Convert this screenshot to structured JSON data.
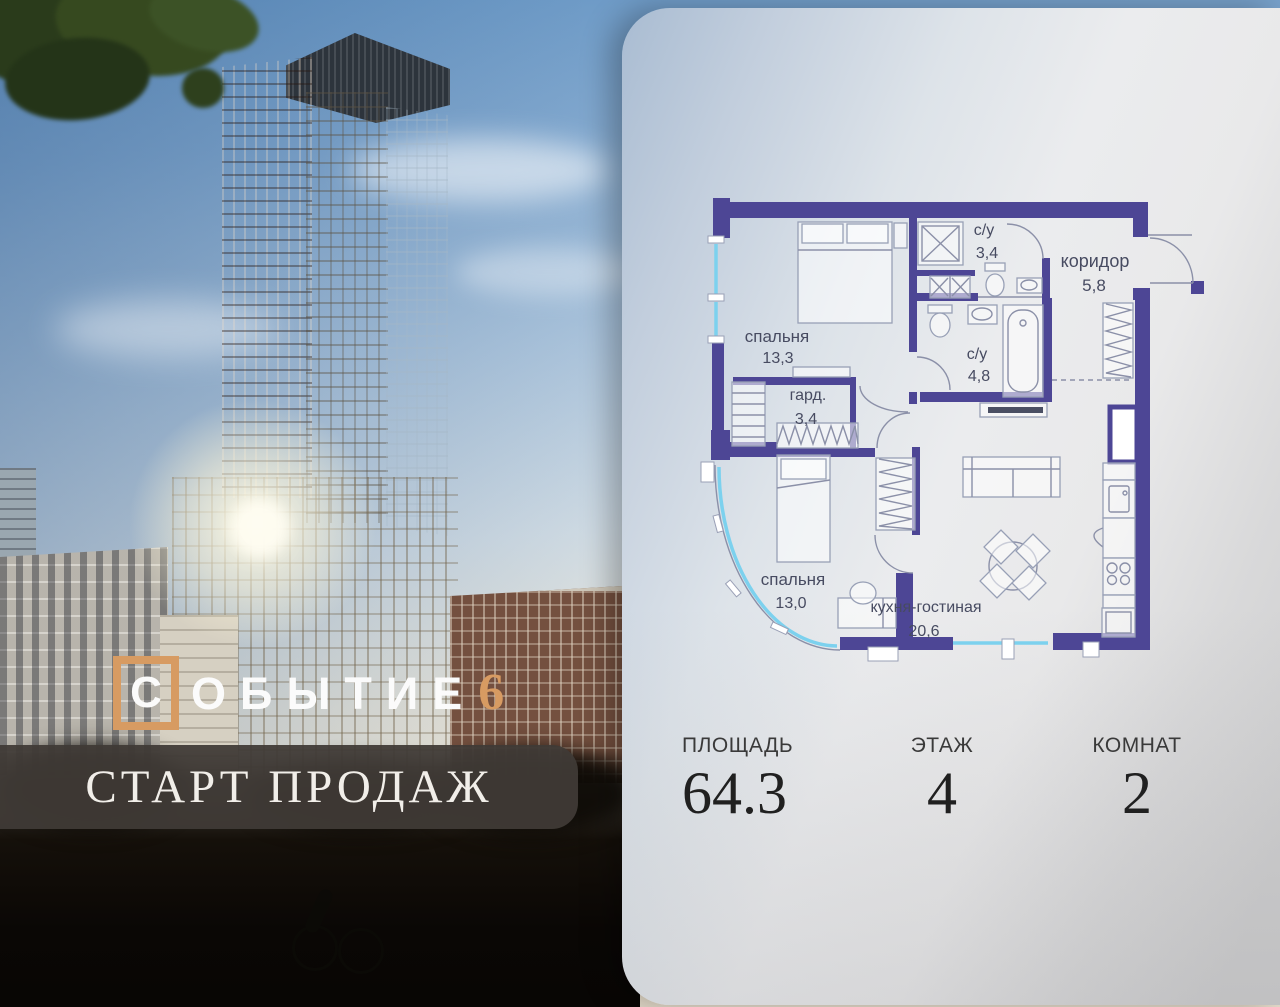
{
  "logo": {
    "boxed_letter": "С",
    "rest": "ОБЫТИЕ",
    "number": "6"
  },
  "banner": {
    "text": "СТАРТ ПРОДАЖ"
  },
  "floorplan": {
    "rooms": [
      {
        "name": "спальня",
        "area": "13,3"
      },
      {
        "name": "с/у",
        "area": "3,4"
      },
      {
        "name": "коридор",
        "area": "5,8"
      },
      {
        "name": "с/у",
        "area": "4,8"
      },
      {
        "name": "гард.",
        "area": "3,4"
      },
      {
        "name": "спальня",
        "area": "13,0"
      },
      {
        "name": "кухня-гостиная",
        "area": "20,6"
      }
    ],
    "colors": {
      "wall": "#4d4695",
      "window": "#7cd1ee",
      "furniture": "#98a0b6",
      "label": "#474b61"
    }
  },
  "stats": {
    "items": [
      {
        "label": "ПЛОЩАДЬ",
        "value": "64.3"
      },
      {
        "label": "ЭТАЖ",
        "value": "4"
      },
      {
        "label": "КОМНАТ",
        "value": "2"
      }
    ]
  },
  "colors": {
    "accent": "#d79b62",
    "banner_bg": "#403a36"
  }
}
